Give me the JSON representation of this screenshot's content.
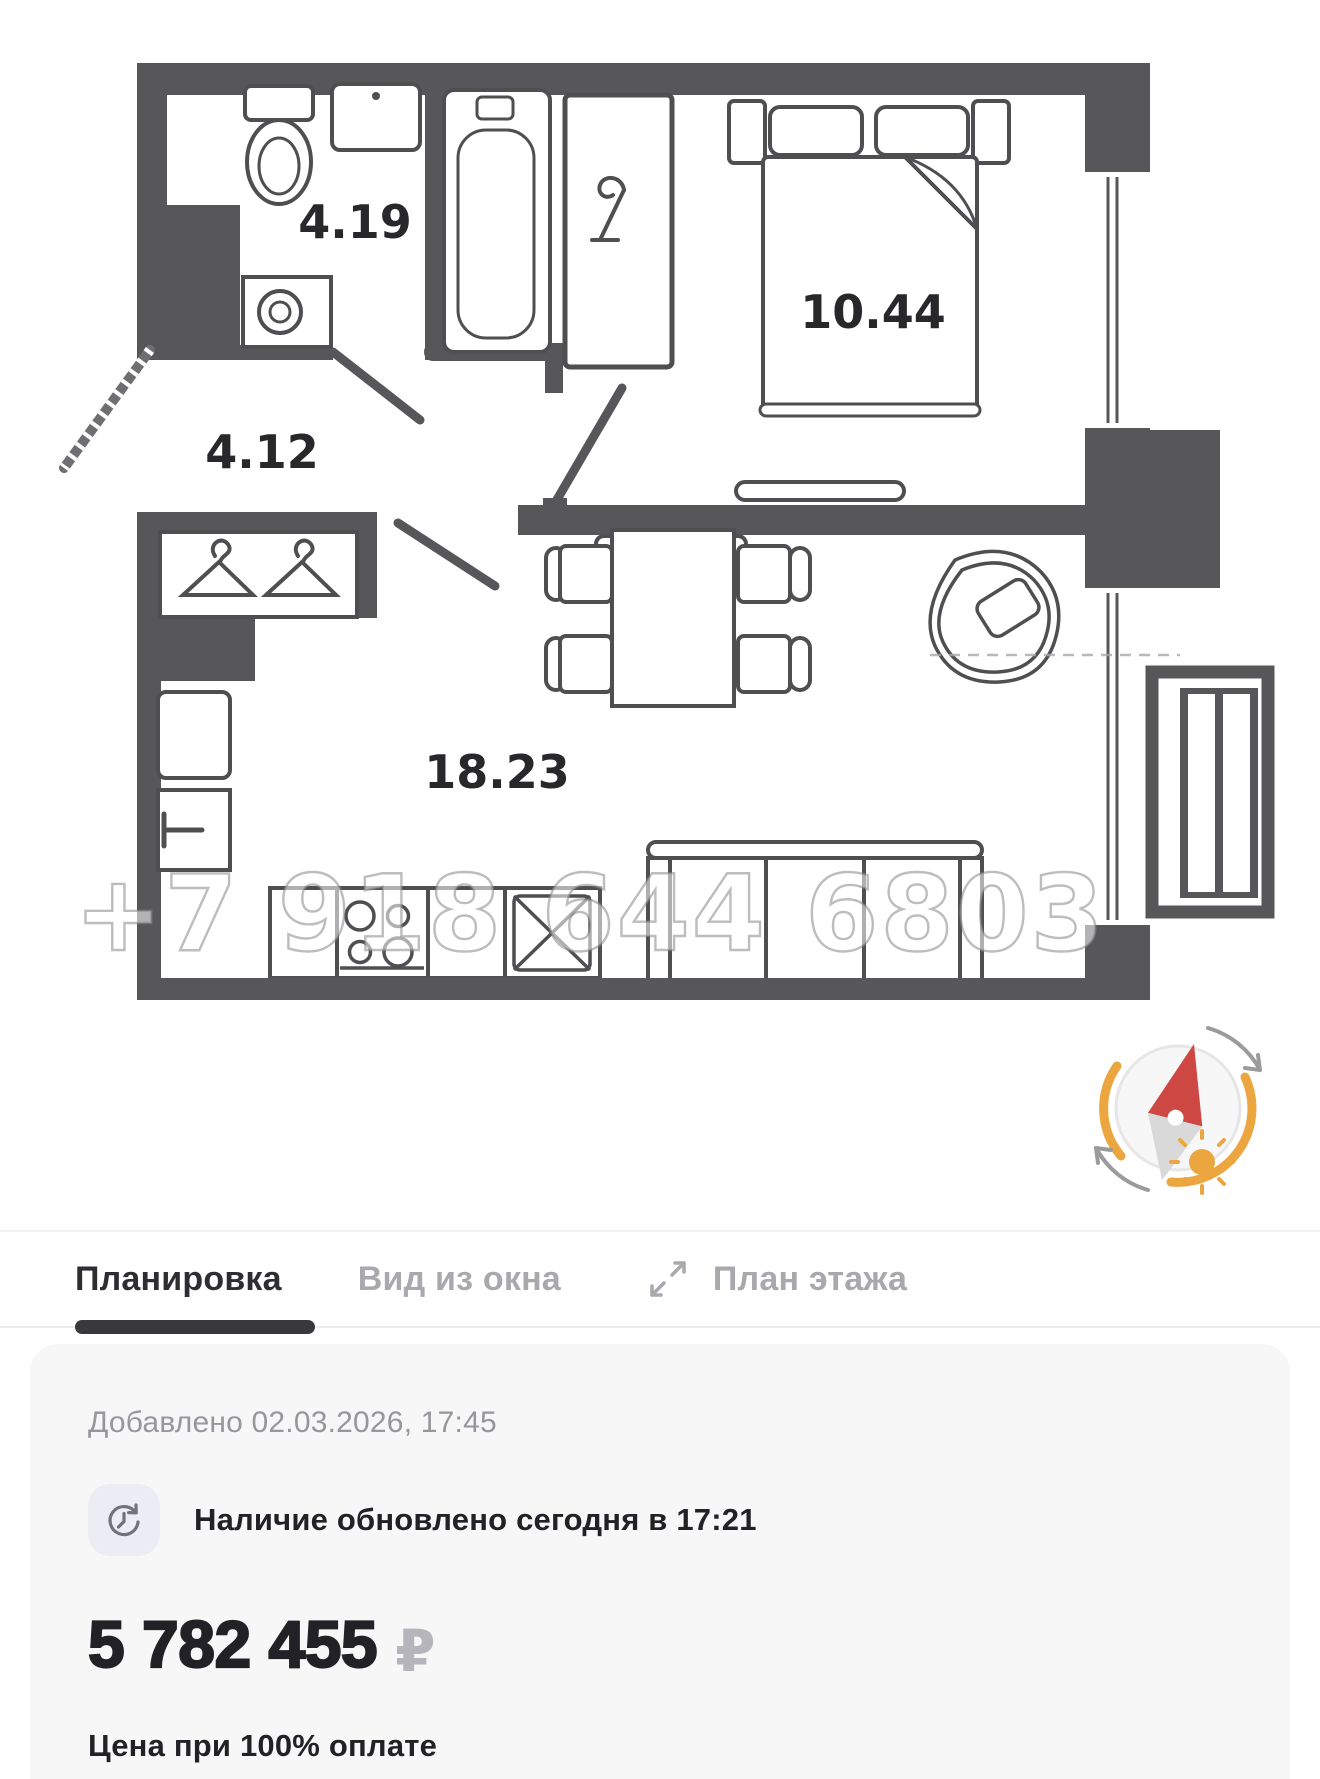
{
  "plan": {
    "rooms": {
      "bathroom": "4.19",
      "hallway": "4.12",
      "bedroom": "10.44",
      "living": "18.23"
    },
    "watermark": "+7 918 644 6803",
    "wall_color": "#57575a",
    "line_color": "#4f4f52"
  },
  "compass": {
    "icon": "sun-compass-icon",
    "needle_red": "#cd4843",
    "needle_gray": "#d9d9d9",
    "arc_orange": "#eba63f",
    "arrow_gray": "#9b9b9b"
  },
  "tabs": {
    "layout": "Планировка",
    "window_view": "Вид из окна",
    "floor_plan": "План этажа",
    "active_color": "#2e2e32",
    "inactive_color": "#a9a9ad"
  },
  "card": {
    "added": "Добавлено 02.03.2026, 17:45",
    "availability": "Наличие обновлено сегодня в 17:21",
    "price": "5 782 455",
    "currency": "₽",
    "note": "Цена при 100% оплате"
  }
}
